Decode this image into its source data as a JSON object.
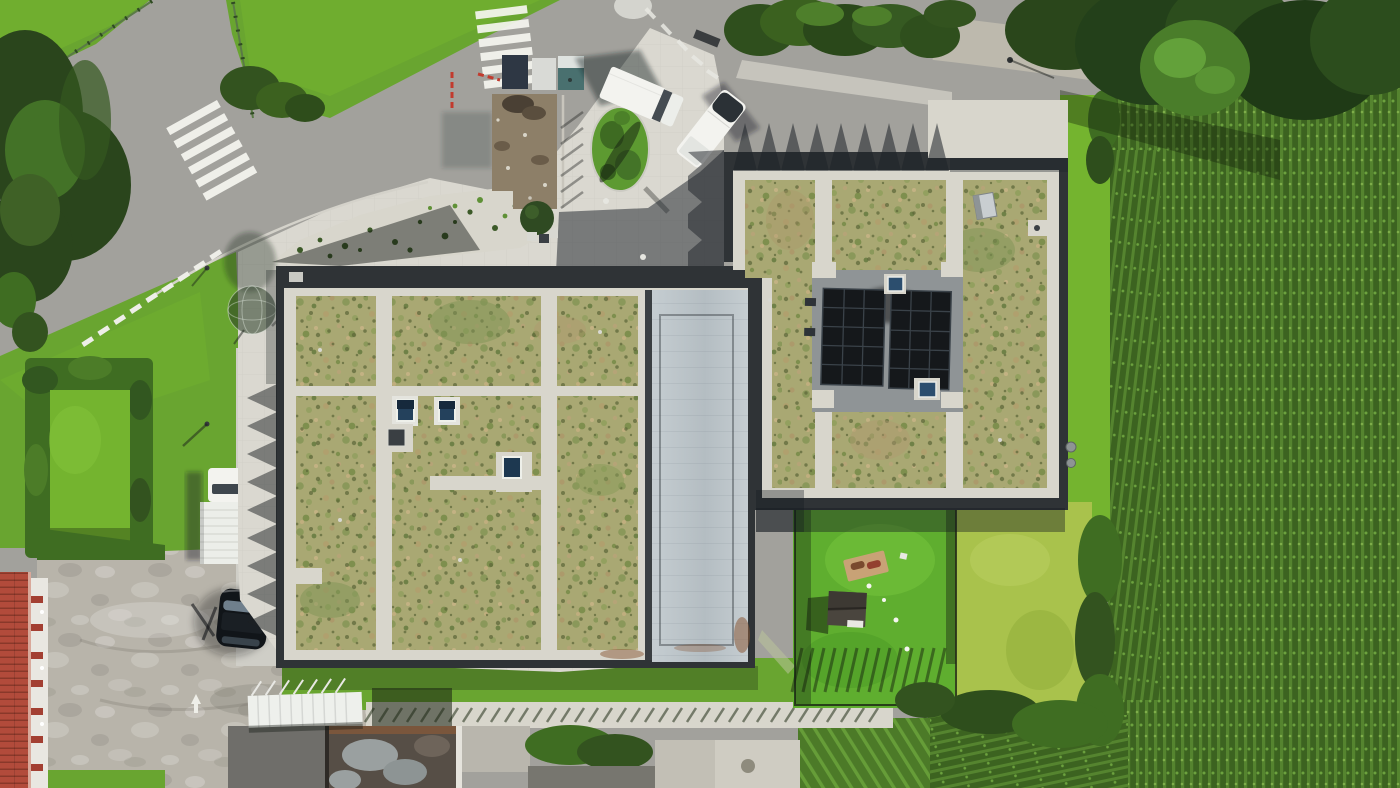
{
  "meta": {
    "title": "Aerial drone view of two flat-roof buildings with extensive sedum green roofs",
    "description": "Top-down photo: main building with sedum roof panels, white gravel maintenance strips and a gray membrane section; annex building with two rooftop solar arrays; entrance plaza with construction materials; asphalt junction with zebra crossings; gravel lot with parked vehicles; fenced play garden with playhouse; hedge-framed lawn; red tiled roof at the west edge; cornfield across the east."
  },
  "palette": {
    "asphalt": "#a2a19c",
    "pavement": "#dad8d0",
    "pavementShade": "#cfcec7",
    "gravelLot": "#b8b4aa",
    "gravelStrip": "#d8d6cc",
    "gravelPath": "#bdb9ad",
    "membraneA": "#c5cdd1",
    "membraneB": "#b4bdc2",
    "padGray": "#8f9496",
    "parapet": "#2f3336",
    "sedumBase": "#a9a873",
    "grass": "#69a530",
    "grassBright": "#74b42f",
    "lawnPlay": "#5fae2f",
    "lawnYellow": "#a9c24c",
    "hedge": "#3f6d22",
    "treeDark": "#2a451c",
    "treeLight": "#4a7d2a",
    "corn": "#3c6320",
    "cornRow": "#55842f",
    "solar": "#15181b",
    "solarLine": "#3a4249",
    "skylight": "#24415c",
    "white": "#f3f3ef",
    "carBlack": "#111519",
    "roofRed": "#b24b3b",
    "facade": "#e9e7e1",
    "dirt": "#8d7f68",
    "rust": "#8a5a38",
    "shadow": "rgba(30,36,44,0.52)"
  },
  "objects": {
    "left_building": {
      "label": "Main building sedum green roof",
      "sedum_panels": 3,
      "gravel_strips": 4,
      "skylights": 3,
      "membrane_section": 1
    },
    "right_building": {
      "label": "Annex building green roof with solar arrays",
      "sedum_panels": 3,
      "solar_arrays": 2,
      "skylights": 2,
      "rooftop_unit": 1
    },
    "vehicles": [
      {
        "type": "box van",
        "color": "white",
        "location": "plaza"
      },
      {
        "type": "pickup truck",
        "color": "white",
        "location": "street edge"
      },
      {
        "type": "box truck",
        "color": "white",
        "location": "west walkway"
      },
      {
        "type": "car",
        "color": "black",
        "location": "gravel lot"
      }
    ],
    "road_markings": {
      "zebra_crossings": 2,
      "painted_circle": 1,
      "give_way_dashes": 9,
      "centerline_dashes": 5,
      "drain_grate": 1
    },
    "plaza": {
      "label": "Entrance plaza",
      "planting_island": 1,
      "construction_dirt_patch": 1,
      "material_pallets": 3,
      "young_trees": 2,
      "bollards": 3,
      "gravel_plant_bed": 1
    },
    "play_garden": {
      "label": "Fenced play garden",
      "playhouse": 1,
      "picnic_blanket": 1,
      "balls": 4
    },
    "landscape": {
      "cornfield": "east",
      "hedge_square_lawn": "southwest",
      "gravel_lot": "southwest",
      "red_tile_roof_building": "west edge",
      "bike_shelter": 1,
      "container_roof": 1,
      "concrete_pad": 1,
      "tree_groups": [
        "northwest conifers",
        "northeast broadleaf"
      ]
    }
  }
}
